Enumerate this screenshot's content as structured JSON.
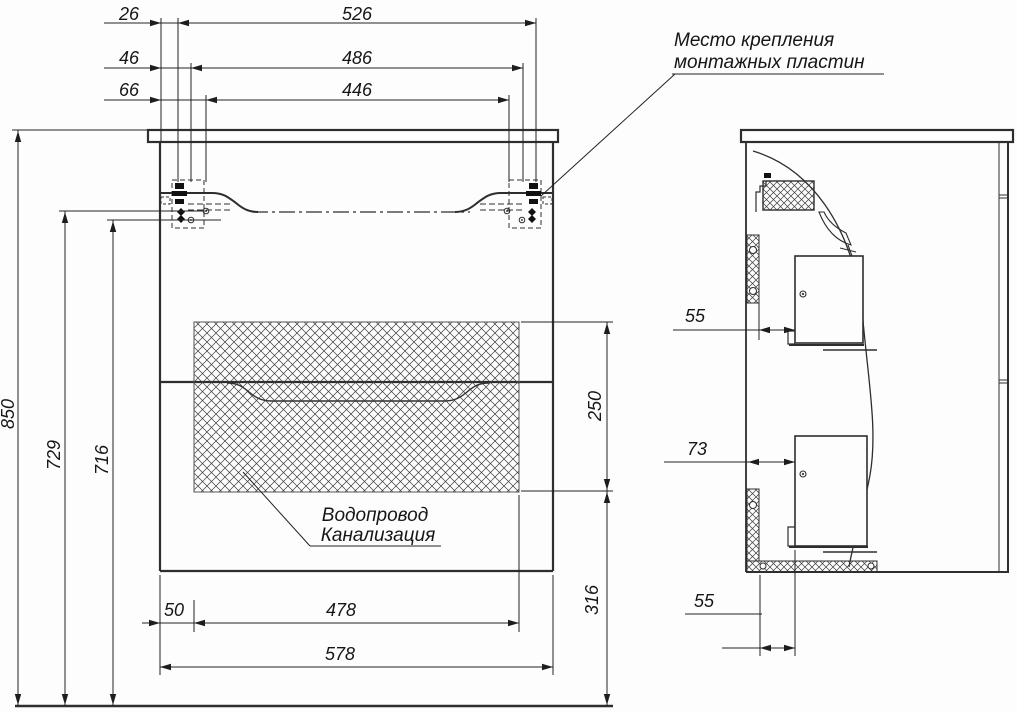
{
  "annotations": {
    "mounting_plates": {
      "line1": "Место крепления",
      "line2": "монтажных пластин"
    },
    "plumbing": {
      "line1": "Водопровод",
      "line2": "Канализация"
    }
  },
  "front_view": {
    "horizontal_dims_top": {
      "offset1": "26",
      "span1": "526",
      "offset2": "46",
      "span2": "486",
      "offset3": "66",
      "span3": "446"
    },
    "vertical_dims_left": {
      "total_height": "850",
      "upper_hole_height": "729",
      "lower_hole_height": "716"
    },
    "vertical_dims_right": {
      "opening_height": "250",
      "opening_bottom_height": "316"
    },
    "horizontal_dims_bottom": {
      "side_offset": "50",
      "opening_width": "478",
      "total_width": "578"
    }
  },
  "side_view": {
    "dims": {
      "top_offset": "55",
      "middle_offset": "73",
      "bottom_offset": "55"
    }
  },
  "colors": {
    "line": "#2e2e2e",
    "thin": "#222222",
    "hatch": "#3c3c3c"
  }
}
